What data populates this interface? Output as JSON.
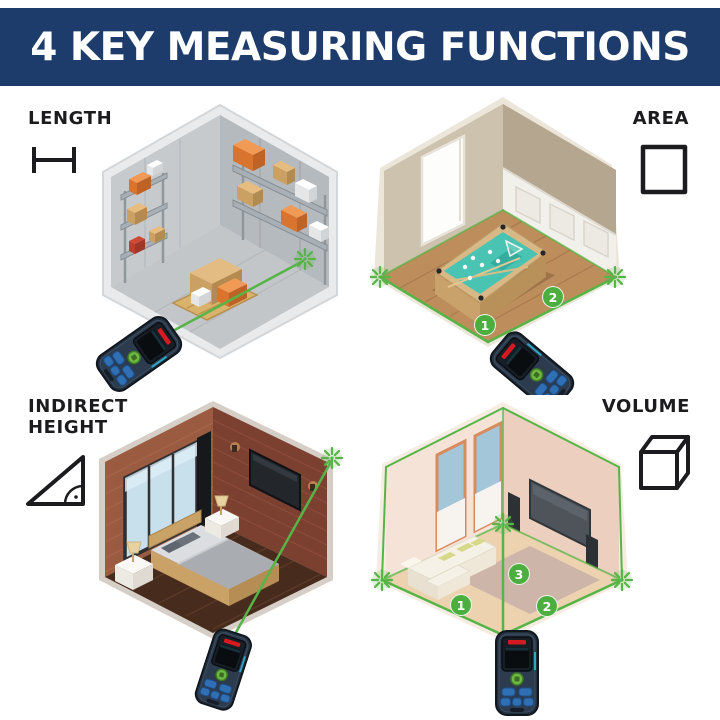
{
  "header": {
    "title": "4 KEY MEASURING FUNCTIONS"
  },
  "sections": {
    "length": {
      "label": "LENGTH",
      "icon": "length-extents-icon"
    },
    "area": {
      "label": "AREA",
      "icon": "area-square-icon",
      "badges": [
        "1",
        "2"
      ]
    },
    "indirect_height": {
      "label": "INDIRECT HEIGHT",
      "icon": "set-square-icon"
    },
    "volume": {
      "label": "VOLUME",
      "icon": "cube-icon",
      "badges": [
        "1",
        "2",
        "3"
      ]
    }
  },
  "colors": {
    "header_bg": "#1d3c6b",
    "header_text": "#ffffff",
    "label_text": "#1c1c1e",
    "laser_green": "#57b447",
    "badge_green": "#4cae3f",
    "device_body": "#232f3d",
    "device_logo_red": "#d61a21",
    "device_button_blue": "#2f6fb3",
    "device_button_green": "#6fb944"
  }
}
